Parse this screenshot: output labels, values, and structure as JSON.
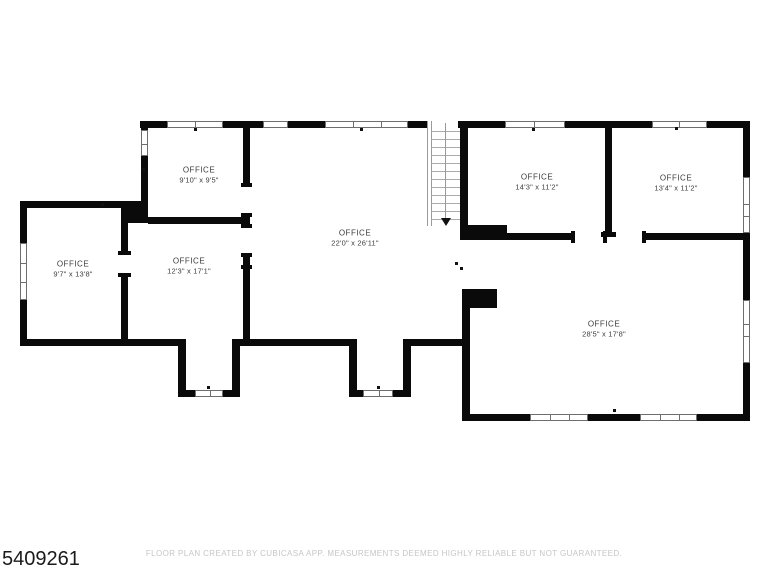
{
  "plan_id": "5409261",
  "footer": {
    "text": "FLOOR PLAN CREATED BY CUBICASA APP. MEASUREMENTS DEEMED HIGHLY RELIABLE BUT NOT GUARANTEED."
  },
  "rooms": [
    {
      "name": "OFFICE",
      "dims": "9'10\" x 9'5\""
    },
    {
      "name": "OFFICE",
      "dims": "9'7\" x 13'8\""
    },
    {
      "name": "OFFICE",
      "dims": "12'3\" x 17'1\""
    },
    {
      "name": "OFFICE",
      "dims": "22'0\" x 26'11\""
    },
    {
      "name": "OFFICE",
      "dims": "14'3\" x 11'2\""
    },
    {
      "name": "OFFICE",
      "dims": "13'4\" x 11'2\""
    },
    {
      "name": "OFFICE",
      "dims": "28'5\" x 17'8\""
    }
  ],
  "features": {
    "staircase": {
      "treads": 13,
      "arrow_direction": "down"
    },
    "window_count": 13,
    "door_opening_count": 6
  },
  "colors": {
    "wall": "#0a0a0a",
    "background": "#ffffff",
    "label_text": "#3d3d3d",
    "footer_text": "#c6c6c6",
    "stair_lines": "#9a9a9a"
  }
}
